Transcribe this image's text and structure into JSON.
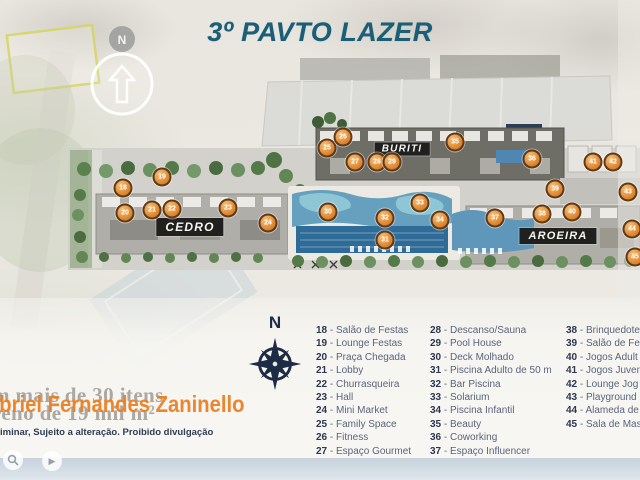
{
  "page": {
    "title": "3º PAVTO LAZER"
  },
  "map": {
    "buildings": [
      {
        "name": "CEDRO"
      },
      {
        "name": "BURITI"
      },
      {
        "name": "AROEIRA"
      }
    ],
    "compass_top": {
      "label": "N"
    },
    "compass_rose": {
      "label": "N"
    },
    "markers": [
      {
        "n": "18",
        "x": 123,
        "y": 188
      },
      {
        "n": "19",
        "x": 162,
        "y": 177
      },
      {
        "n": "20",
        "x": 125,
        "y": 213
      },
      {
        "n": "21",
        "x": 152,
        "y": 210
      },
      {
        "n": "22",
        "x": 172,
        "y": 209
      },
      {
        "n": "23",
        "x": 228,
        "y": 208
      },
      {
        "n": "24",
        "x": 268,
        "y": 223
      },
      {
        "n": "25",
        "x": 327,
        "y": 148
      },
      {
        "n": "26",
        "x": 343,
        "y": 137
      },
      {
        "n": "27",
        "x": 355,
        "y": 162
      },
      {
        "n": "28",
        "x": 377,
        "y": 162
      },
      {
        "n": "29",
        "x": 392,
        "y": 162
      },
      {
        "n": "30",
        "x": 328,
        "y": 212
      },
      {
        "n": "31",
        "x": 385,
        "y": 240
      },
      {
        "n": "32",
        "x": 385,
        "y": 218
      },
      {
        "n": "33",
        "x": 420,
        "y": 203
      },
      {
        "n": "34",
        "x": 440,
        "y": 220
      },
      {
        "n": "35",
        "x": 455,
        "y": 142
      },
      {
        "n": "36",
        "x": 532,
        "y": 159
      },
      {
        "n": "37",
        "x": 495,
        "y": 218
      },
      {
        "n": "38",
        "x": 542,
        "y": 214
      },
      {
        "n": "39",
        "x": 555,
        "y": 189
      },
      {
        "n": "40",
        "x": 572,
        "y": 212
      },
      {
        "n": "41",
        "x": 593,
        "y": 162
      },
      {
        "n": "42",
        "x": 613,
        "y": 162
      },
      {
        "n": "43",
        "x": 628,
        "y": 192
      },
      {
        "n": "44",
        "x": 632,
        "y": 229
      },
      {
        "n": "45",
        "x": 635,
        "y": 257
      }
    ]
  },
  "legend": {
    "columns": [
      {
        "items": [
          {
            "num": "18",
            "label": "Salão de Festas"
          },
          {
            "num": "19",
            "label": "Lounge Festas"
          },
          {
            "num": "20",
            "label": "Praça Chegada"
          },
          {
            "num": "21",
            "label": "Lobby"
          },
          {
            "num": "22",
            "label": "Churrasqueira"
          },
          {
            "num": "23",
            "label": "Hall"
          },
          {
            "num": "24",
            "label": "Mini Market"
          },
          {
            "num": "25",
            "label": "Family Space"
          },
          {
            "num": "26",
            "label": "Fitness"
          },
          {
            "num": "27",
            "label": "Espaço Gourmet"
          }
        ]
      },
      {
        "items": [
          {
            "num": "28",
            "label": "Descanso/Sauna"
          },
          {
            "num": "29",
            "label": "Pool House"
          },
          {
            "num": "30",
            "label": "Deck Molhado"
          },
          {
            "num": "31",
            "label": "Piscina Adulto de 50 m"
          },
          {
            "num": "32",
            "label": "Bar Piscina"
          },
          {
            "num": "33",
            "label": "Solarium"
          },
          {
            "num": "34",
            "label": "Piscina Infantil"
          },
          {
            "num": "35",
            "label": "Beauty"
          },
          {
            "num": "36",
            "label": "Coworking"
          },
          {
            "num": "37",
            "label": "Espaço Influencer"
          }
        ]
      },
      {
        "items": [
          {
            "num": "38",
            "label": "Brinquedote"
          },
          {
            "num": "39",
            "label": "Salão de Fes"
          },
          {
            "num": "40",
            "label": "Jogos Adult"
          },
          {
            "num": "41",
            "label": "Jogos Juven"
          },
          {
            "num": "42",
            "label": "Lounge Jog"
          },
          {
            "num": "43",
            "label": "Playground"
          },
          {
            "num": "44",
            "label": "Alameda de"
          },
          {
            "num": "45",
            "label": "Sala de Mas"
          }
        ]
      }
    ]
  },
  "watermarks": {
    "gray_line1": "m mais de 30 itens",
    "gray_line2": "reno de 19 mil m²",
    "orange_name": "abriel Fernandes Zaninello",
    "disclaimer": "iminar, Sujeito a alteração. Proibido divulgação"
  },
  "colors": {
    "title": "#1a5e77",
    "marker_orange": "#e08a33",
    "watermark_orange": "#ec7d1e",
    "pool_blue": "#5e97ba",
    "label_bar": "#20201e",
    "legend_text": "#59647c"
  }
}
